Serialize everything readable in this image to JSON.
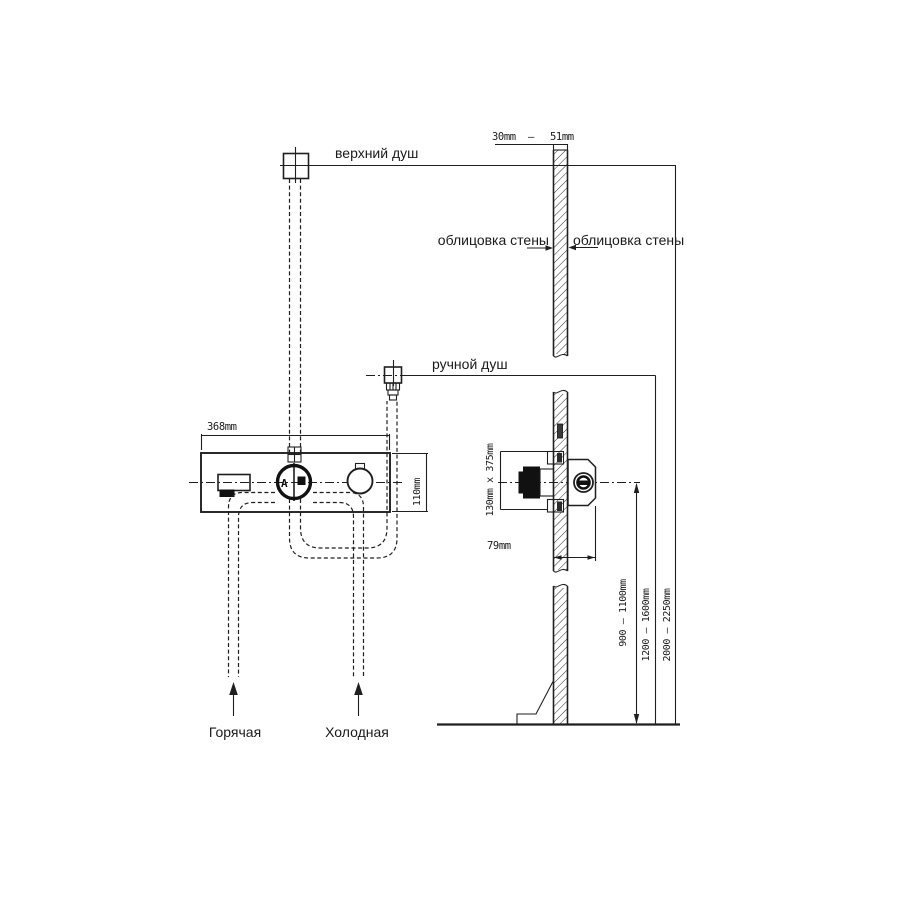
{
  "drawing": {
    "labels": {
      "top_shower": "верхний душ",
      "hand_shower": "ручной душ",
      "wall_cladding_left": "облицовка стены",
      "wall_cladding_right": "облицовка стены",
      "hot_water": "Горячая",
      "cold_water": "Холодная"
    },
    "dimensions": {
      "wall_thickness_min": "30mm",
      "wall_thickness_dash": "—",
      "wall_thickness_max": "51mm",
      "panel_width": "368mm",
      "panel_height": "110mm",
      "rough_in_size": "130mm  x  375mm",
      "rough_in_depth": "79mm",
      "mixer_height_range": "900 — 1100mm",
      "hand_shower_height_range": "1200 — 1600mm",
      "top_shower_height_range": "2000 — 2250mm"
    },
    "dial_marking": "A",
    "line_color": "#1f1f1f",
    "background": "#ffffff"
  }
}
